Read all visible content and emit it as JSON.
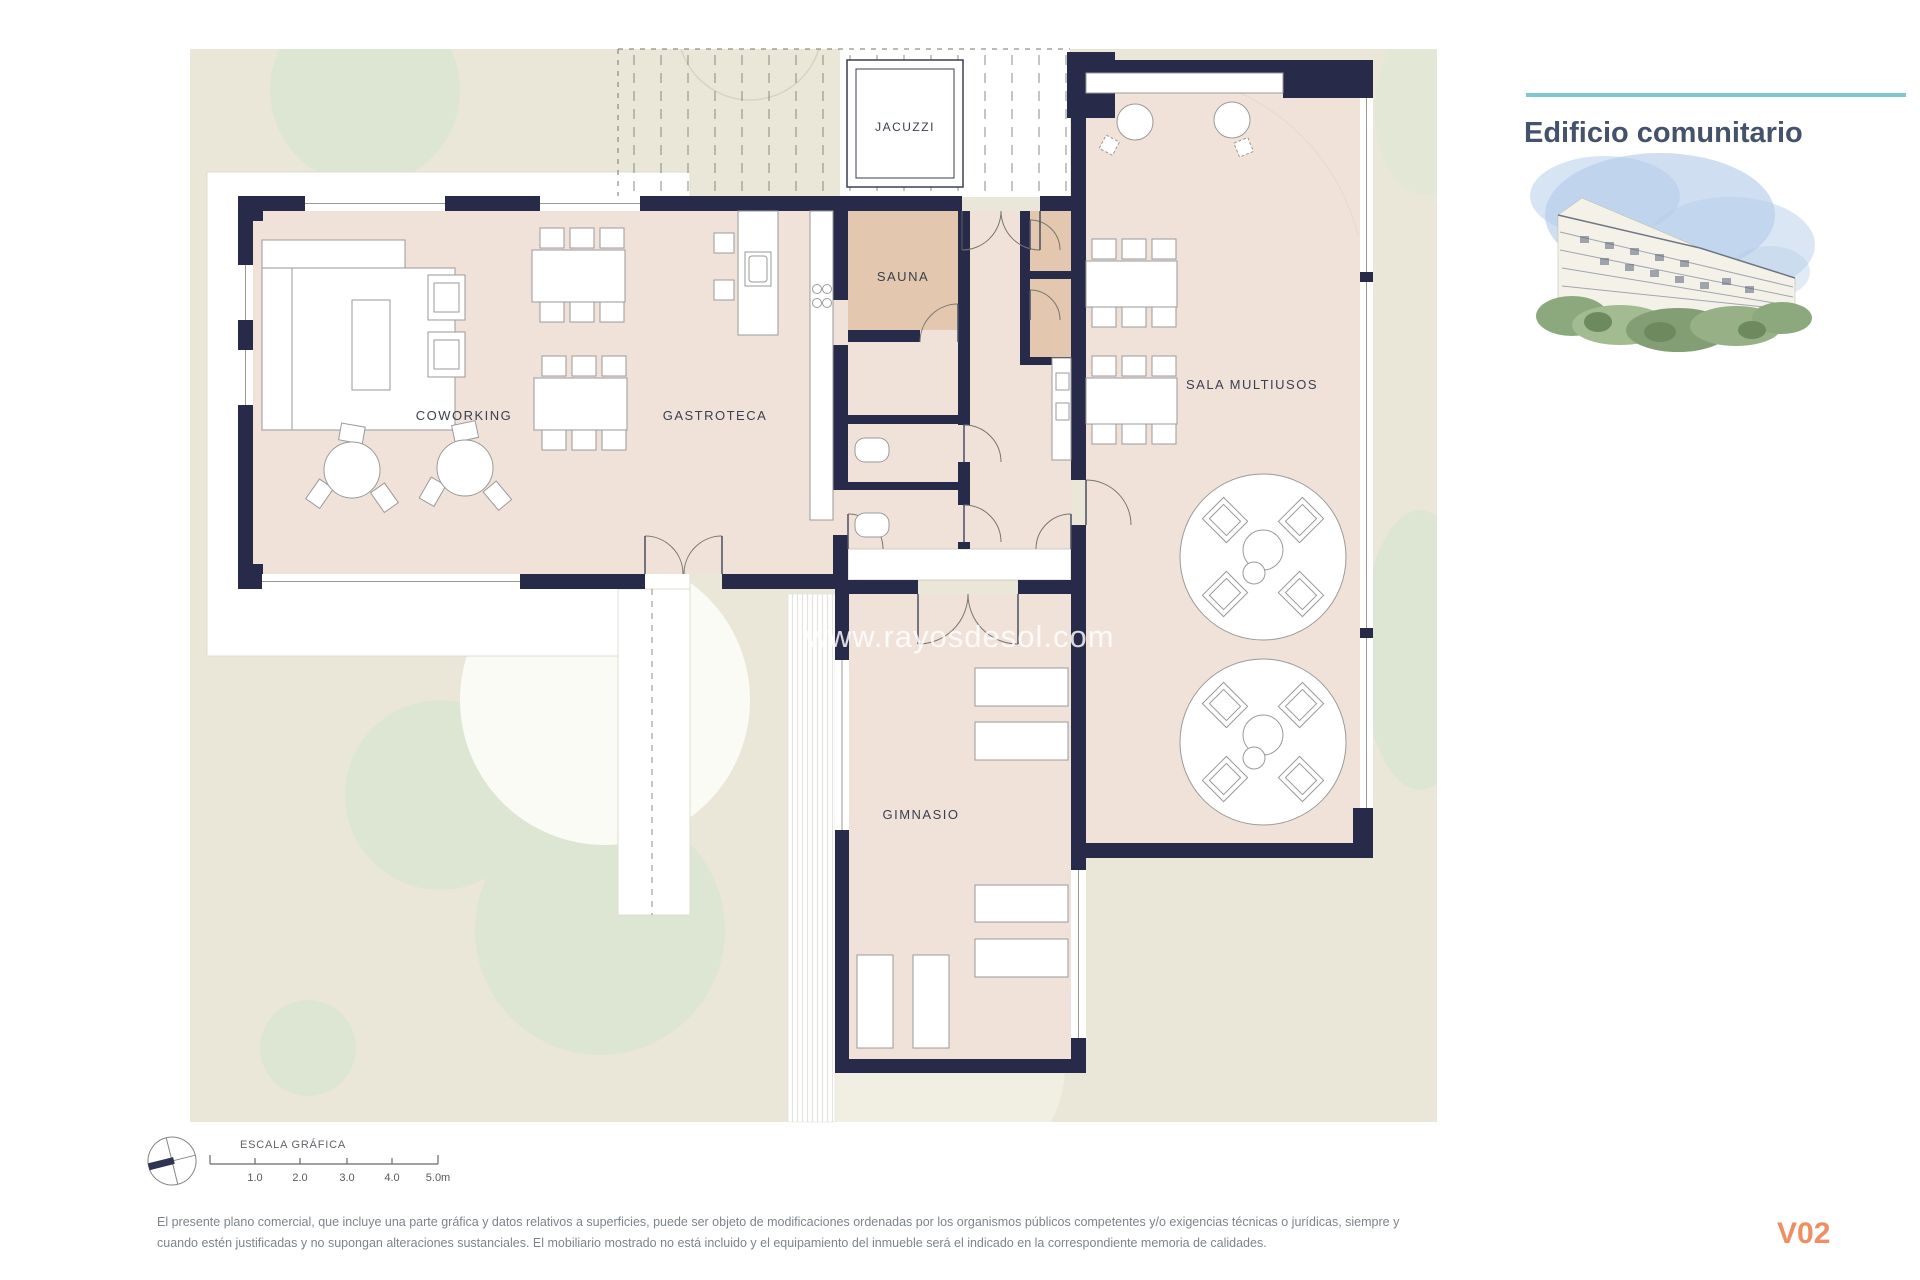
{
  "header": {
    "title": "Edificio comunitario"
  },
  "plan": {
    "watermark": "www.rayosdesol.com",
    "rooms": [
      {
        "id": "jacuzzi",
        "label": "JACUZZI"
      },
      {
        "id": "sauna",
        "label": "SAUNA"
      },
      {
        "id": "coworking",
        "label": "COWORKING"
      },
      {
        "id": "gastroteca",
        "label": "GASTROTECA"
      },
      {
        "id": "sala-multiusos",
        "label": "SALA MULTIUSOS"
      },
      {
        "id": "gimnasio",
        "label": "GIMNASIO"
      }
    ]
  },
  "scale_bar": {
    "heading": "ESCALA GRÁFICA",
    "ticks": [
      "1.0",
      "2.0",
      "3.0",
      "4.0",
      "5.0m"
    ]
  },
  "footer": {
    "disclaimer_line_1": "El presente plano comercial, que incluye una parte gráfica y datos relativos a superficies, puede ser objeto de modificaciones ordenadas por los organismos públicos competentes y/o exigencias técnicas o jurídicas, siempre y",
    "disclaimer_line_2": "cuando estén justificadas y no supongan alteraciones sustanciales. El mobiliario mostrado no está incluido y el equipamiento del inmueble será el indicado en la correspondiente memoria de calidades.",
    "version": "V02"
  },
  "colors": {
    "wall": "#272b49",
    "room_fill": "#f0e2d9",
    "sauna_fill": "#e3c7ae",
    "site_fill": "#eae7d9",
    "tree_fill": "#dde6d3",
    "accent_teal": "#7fc9ce",
    "version_orange": "#ef8e63",
    "title_color": "#44526b"
  }
}
